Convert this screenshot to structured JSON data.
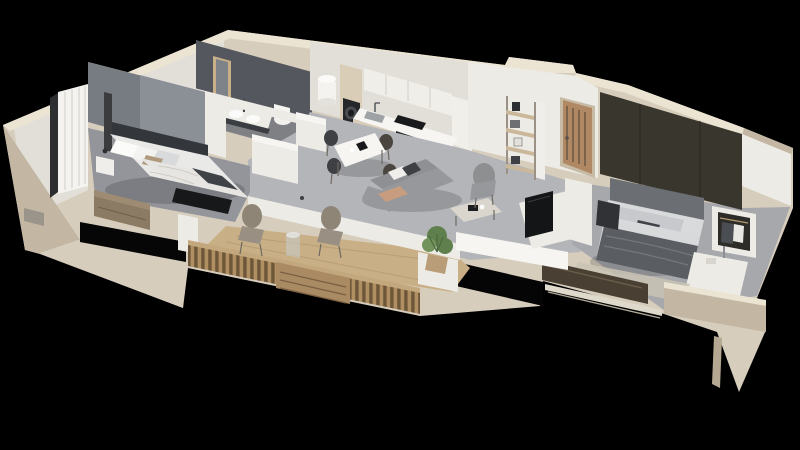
{
  "scene": {
    "type": "3d-floorplan-cutaway-render",
    "view": "isometric-top-down",
    "background": "#000000",
    "palette": {
      "wallCream": "#d7cdbd",
      "wallTop": "#ece4d3",
      "wallShadow": "#c3b7a3",
      "interiorWhite": "#edebe6",
      "bathroomWall": "#54585e",
      "accentWallLeft": "#777c83",
      "accentWallRight": "#39362e",
      "floorConcrete": "#b4b5b9",
      "floorBedroomLeft": "#93959b",
      "floorBedroomRight": "#a7a8ac",
      "floorBathroom": "#7e8084",
      "deckWood": "#c9af86",
      "fenceWood": "#8a6f4e",
      "doorWood": "#b08964",
      "sofaGray": "#97989c",
      "bedLinen": "#e9e9e7",
      "blanketGray": "#5a5d61",
      "tvBlack": "#141517",
      "plantGreen": "#5f7f4d"
    },
    "rooms": [
      {
        "id": "bedroom-left",
        "furniture": [
          "double-bed",
          "fabric-headboard-panel",
          "pillows",
          "nightstand",
          "black-foot-bench",
          "wood-dresser",
          "curtains",
          "floor-mirror"
        ]
      },
      {
        "id": "bathroom",
        "furniture": [
          "double-sink-vanity",
          "wall-mirror",
          "toilet",
          "bathtub",
          "water-heater"
        ]
      },
      {
        "id": "kitchen",
        "furniture": [
          "upper-cabinets",
          "tall-cabinet",
          "washing-machine",
          "fridge-panel",
          "countertop",
          "sink",
          "faucet",
          "cooktop",
          "oven"
        ]
      },
      {
        "id": "dining-area",
        "furniture": [
          "dining-table",
          "four-chairs",
          "table-decor"
        ]
      },
      {
        "id": "living-room",
        "furniture": [
          "gray-sofa",
          "throw-pillows",
          "coffee-table",
          "accent-chair",
          "shelving-unit",
          "tv-on-half-wall",
          "potted-plant"
        ]
      },
      {
        "id": "entry",
        "furniture": [
          "entrance-door"
        ]
      },
      {
        "id": "bedroom-right",
        "furniture": [
          "double-bed",
          "dark-accent-wall",
          "open-wardrobe",
          "nightstand-vanity",
          "laundry-basket",
          "rug",
          "sliding-glass-door"
        ]
      },
      {
        "id": "terrace",
        "furniture": [
          "wood-deck",
          "slatted-wood-fence",
          "slat-bench",
          "rope-chair",
          "rope-chair",
          "glass-side-table",
          "potted-plant",
          "parapet-walls"
        ]
      }
    ]
  }
}
